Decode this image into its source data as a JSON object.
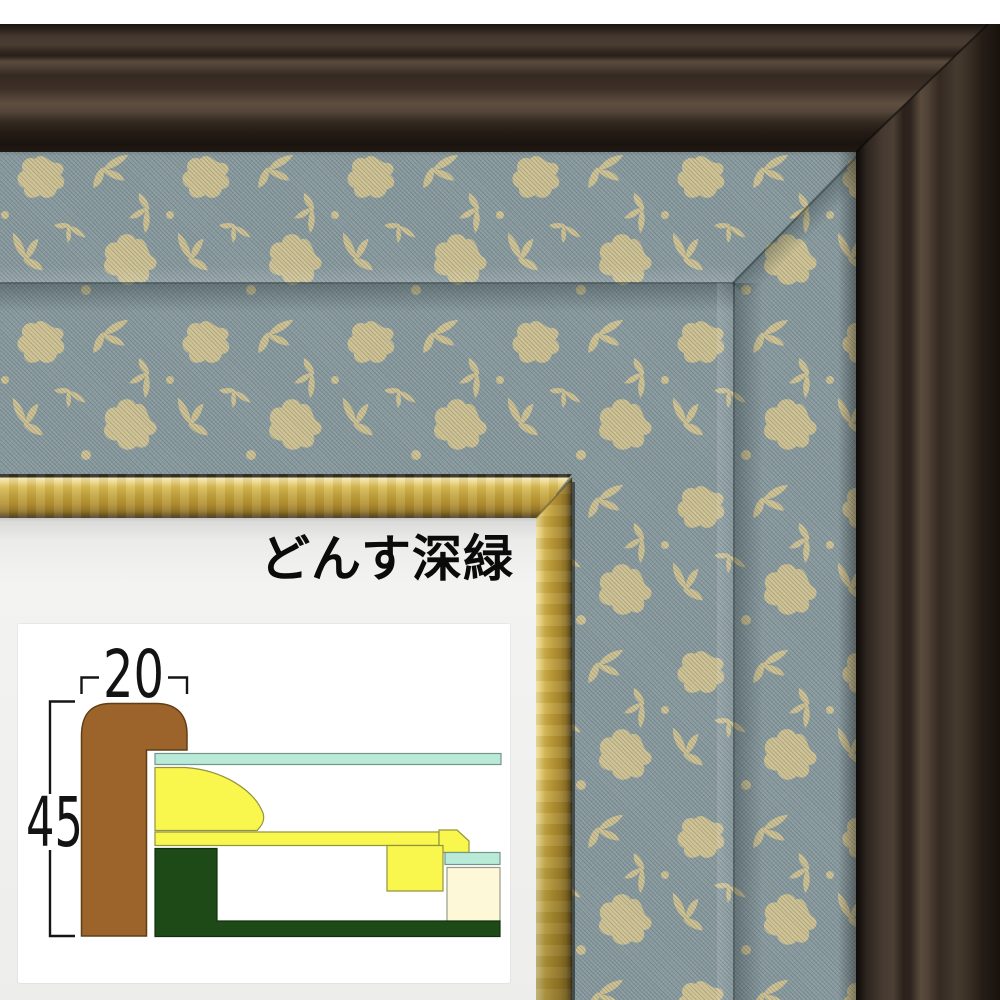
{
  "photo": {
    "product_label": "どんす深緑",
    "colors": {
      "outer_frame": "#32281f",
      "gold_trim": "#c2a13c",
      "fabric_base": "#8a9ba0",
      "fabric_floral": "#d5c691",
      "mat": "#f0f0ee"
    }
  },
  "diagram": {
    "width_label": "20",
    "height_label": "45",
    "colors": {
      "molding": "#9c642a",
      "molding_outline": "#5f3e16",
      "glass": "#b9ead7",
      "glass_outline": "#74958a",
      "mat_profile": "#f9f74e",
      "mat_outline": "#94943c",
      "liner": "#1d4a17",
      "liner_outline": "#12300e",
      "backing": "#fcf8d8",
      "backing_outline": "#9a9a8a",
      "dimension_line": "#151515"
    }
  }
}
